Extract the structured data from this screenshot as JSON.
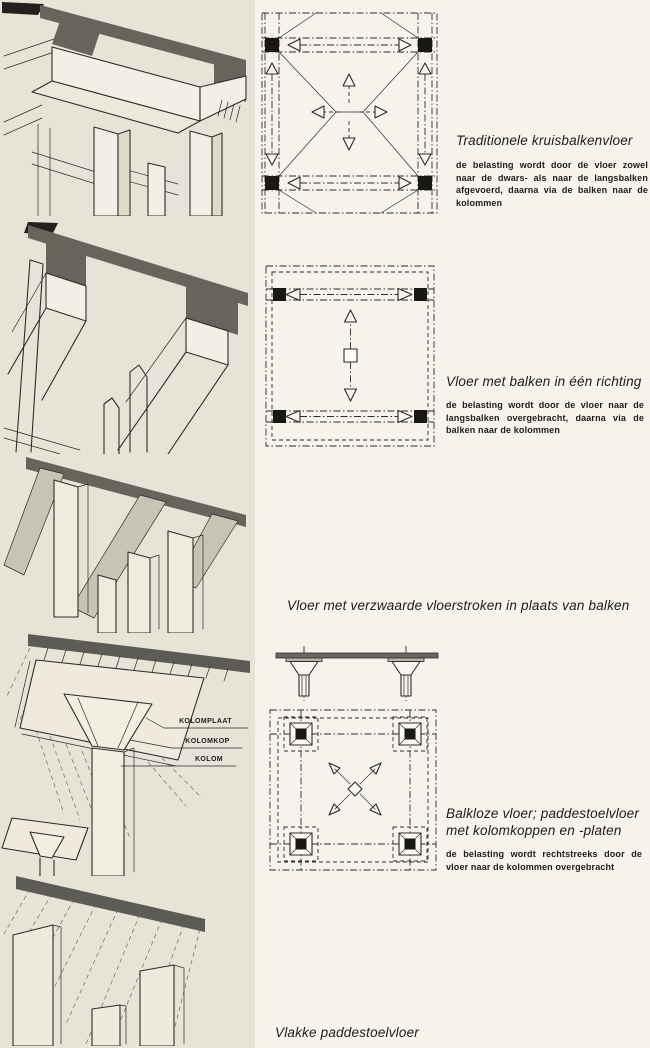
{
  "page": {
    "language": "nl",
    "colors": {
      "paper": "#f5f3ec",
      "panel_paper": "#e7e3d7",
      "slab_gray": "#66645d",
      "ink": "#2e2c29",
      "text_color": "#1d1c1a"
    }
  },
  "sections": [
    {
      "id": "traditionele-kruisbalkenvloer",
      "title": "Traditionele kruisbalkenvloer",
      "description": "de belasting wordt door de vloer zowel naar de dwars- als naar de langsbalken afgevoerd, daarna via de balken naar de kolommen"
    },
    {
      "id": "vloer-met-balken-in-een-richting",
      "title": "Vloer met balken in één richting",
      "description": "de belasting wordt door de vloer naar de langsbalken overgebracht, daarna via de balken naar de kolommen"
    },
    {
      "id": "vloer-met-verzwaarde-vloerstroken",
      "title": "Vloer met verzwaarde vloerstroken in plaats van balken"
    },
    {
      "id": "balkloze-vloer-paddestoelvloer",
      "title_line1": "Balkloze vloer; paddestoelvloer",
      "title_line2": "met kolomkoppen en -platen",
      "description": "de belasting wordt rechtstreeks door de vloer naar de kolommen overgebracht",
      "drawing_labels": [
        "KOLOMPLAAT",
        "KOLOMKOP",
        "KOLOM"
      ]
    },
    {
      "id": "vlakke-paddestoelvloer",
      "title": "Vlakke paddestoelvloer"
    }
  ]
}
